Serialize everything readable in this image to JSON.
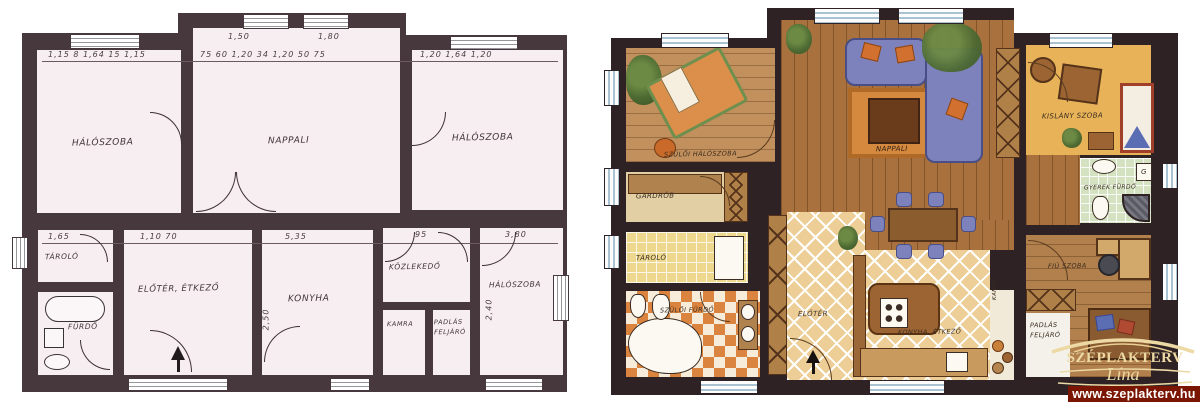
{
  "brand": {
    "title": "SZÉPLAKTERV",
    "script": "Lína"
  },
  "footer": {
    "url": "www.szeplakterv.hu",
    "bar_color": "#7a1501",
    "text_color": "#ffffff"
  },
  "left_plan": {
    "style": "hand-drawn blueprint",
    "wall_color": "#46383c",
    "floor_color": "#f6eef0",
    "rooms": [
      {
        "label": "HÁLÓSZOBA"
      },
      {
        "label": "NAPPALI"
      },
      {
        "label": "HÁLÓSZOBA"
      },
      {
        "label": "TÁROLÓ"
      },
      {
        "label": "FÜRDŐ"
      },
      {
        "label": "ELŐTÉR, ÉTKEZŐ"
      },
      {
        "label": "KONYHA"
      },
      {
        "label": "KÖZLEKEDŐ"
      },
      {
        "label": "KAMRA"
      },
      {
        "label": "PADLÁS FELJÁRÓ"
      },
      {
        "label": "HÁLÓSZOBA"
      }
    ],
    "dims": {
      "top_left": "1,15  8  1,64  15  1,15",
      "mid_a": "1,50",
      "mid_b": "1,80",
      "top_mid": "75  60  1,20  34  1,20  50  75",
      "top_right": "1,20   1,64   1,20",
      "tarolo": "1,65",
      "eloter": "1,10   70",
      "konyha": "5,35",
      "kozlekedo": "95",
      "halo3": "3,80",
      "v_halo3": "2,40",
      "v_konyha": "2,50"
    }
  },
  "right_plan": {
    "style": "color rendered plan",
    "rooms": [
      {
        "label": "SZÜLŐI HÁLÓSZOBA"
      },
      {
        "label": "GARDRÓB"
      },
      {
        "label": "TÁROLÓ"
      },
      {
        "label": "SZÜLŐI FÜRDŐ"
      },
      {
        "label": "ELŐTÉR"
      },
      {
        "label": "NAPPALI"
      },
      {
        "label": "KONYHA, ÉTKEZŐ"
      },
      {
        "label": "KAMRA"
      },
      {
        "label": "PADLÁS FELJÁRÓ"
      },
      {
        "label": "KISLÁNY SZOBA"
      },
      {
        "label": "GYEREK FÜRDŐ"
      },
      {
        "label": "FIÚ SZOBA"
      }
    ],
    "gas_label": "G",
    "colors": {
      "wall": "#2e2225",
      "wood": "#a8713e",
      "rug": "#d4893e",
      "sofa": "#7d82bd",
      "diamond_tile": "#f1e0b8",
      "checker_tile": "#db8440",
      "green_tile": "#d4e2c2",
      "kids_floor": "#e7b258"
    }
  }
}
